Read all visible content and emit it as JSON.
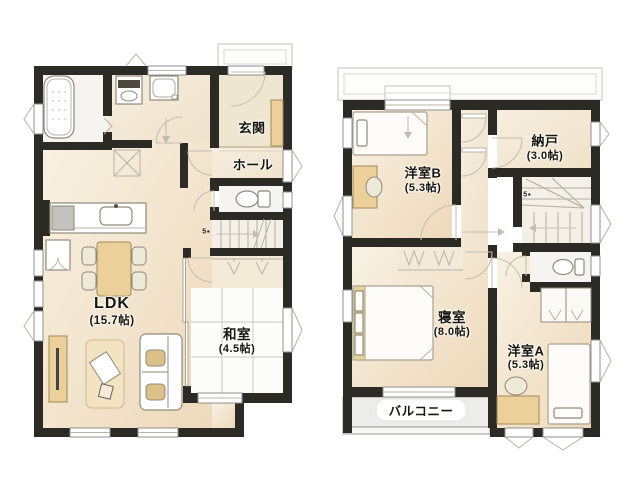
{
  "palette": {
    "wall": "#2c2a25",
    "floor_light": "#f8f0e2",
    "floor_dark": "#eddabb",
    "tatami": "#fcfcf8",
    "furniture_wood": "#ecd09c",
    "balcony": "#ececea"
  },
  "floor1": {
    "rooms": {
      "genkan": {
        "label": "玄関"
      },
      "hall": {
        "label": "ホール"
      },
      "ldk": {
        "label": "LDK",
        "size": "(15.7帖)"
      },
      "washitsu": {
        "label": "和室",
        "size": "(4.5帖)"
      }
    },
    "stair_marker": "5"
  },
  "floor2": {
    "rooms": {
      "western_b": {
        "label": "洋室B",
        "size": "(5.3帖)"
      },
      "storeroom": {
        "label": "納戸",
        "size": "(3.0帖)"
      },
      "bedroom": {
        "label": "寝室",
        "size": "(8.0帖)"
      },
      "western_a": {
        "label": "洋室A",
        "size": "(5.3帖)"
      },
      "balcony": {
        "label": "バルコニー"
      }
    },
    "stair_marker": "5"
  }
}
